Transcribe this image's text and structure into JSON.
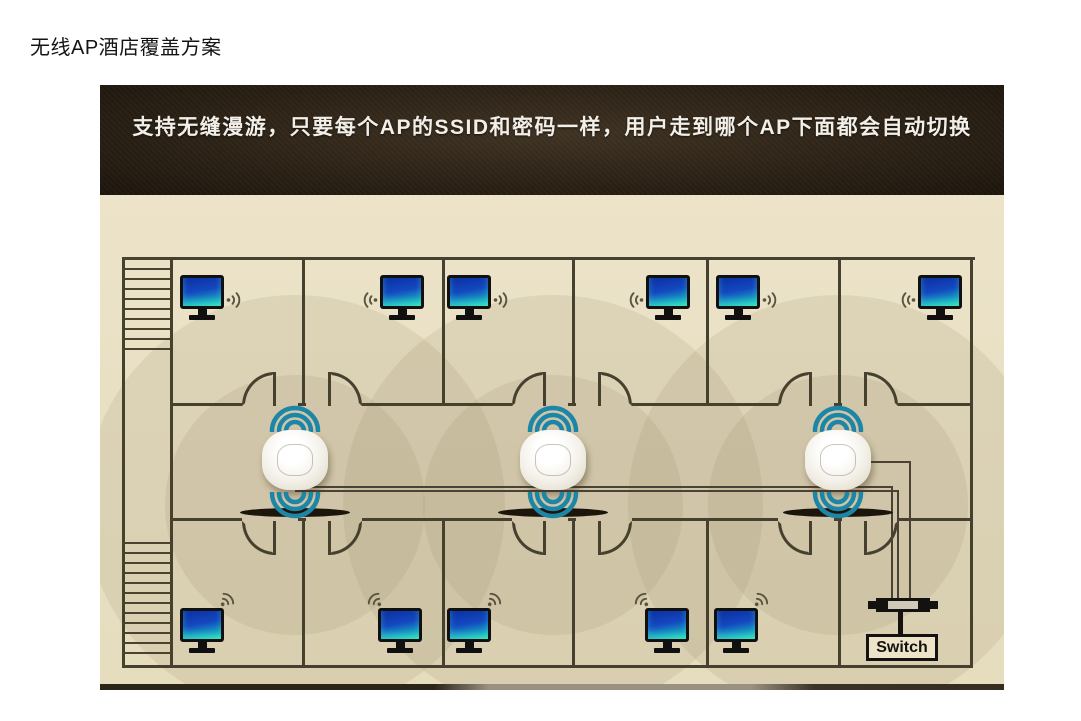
{
  "page": {
    "title": "无线AP酒店覆盖方案"
  },
  "banner": {
    "text": "支持无缝漫游，只要每个AP的SSID和密码一样，用户走到哪个AP下面都会自动切换"
  },
  "diagram": {
    "floor_plan": {
      "top_row": [
        "computer",
        "computer",
        "computer",
        "computer",
        "computer",
        "computer"
      ],
      "bottom_row": [
        "computer",
        "computer",
        "computer",
        "computer",
        "computer"
      ],
      "access_point_count": 3,
      "switch_label": "Switch",
      "has_staircase_top_left": true,
      "has_staircase_bottom_left": true
    },
    "icons": {
      "computer": "monitor-icon",
      "client_signal": "wifi-signal-icon",
      "access_point": "wireless-ap-icon",
      "ap_signal": "wifi-wave-icon",
      "switch": "network-switch-icon"
    },
    "colors": {
      "banner_bg": "#2b2115",
      "banner_text": "#f2efe8",
      "floor_bg": "#e9e0c4",
      "wall": "#46402e",
      "ap_signal": "#1d86a6",
      "monitor_screen_top": "#0c2fa2",
      "monitor_screen_bottom": "#2fd8ae",
      "coverage": "rgba(148,134,98,0.15)"
    }
  }
}
